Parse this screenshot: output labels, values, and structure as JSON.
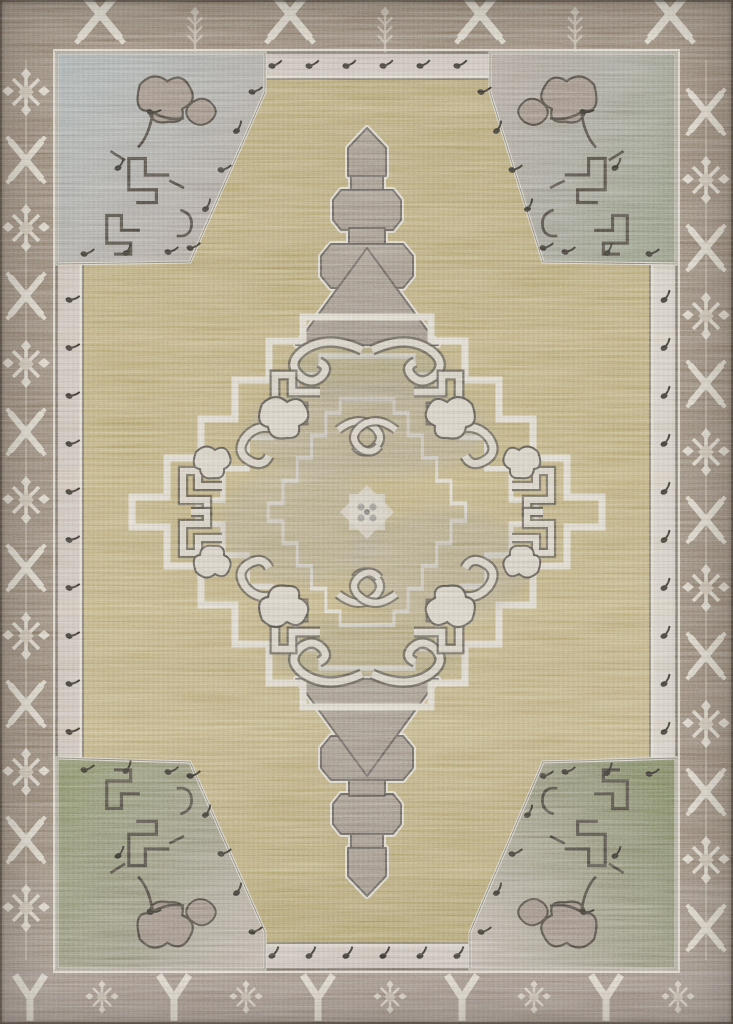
{
  "image": {
    "subject": "Flat-lay product photo of a hand-knotted style area rug: stepped gray central medallion with cream scrollwork on a gold field, four corner spandrels (blue-gray, gray-green and olive) with dark angular vine scrolls, a light dotted inner guard band, and brown tribal borders with white X, Y and snowflake motifs",
    "alt": "Tan, gray and olive geometric medallion area rug"
  },
  "palette": {
    "border_brown": "#8b7a68",
    "border_brown_deep": "#7c6c5b",
    "border_mauve": "#9c8d83",
    "motif_white": "#e7e0d1",
    "motif_dim": "#cfc5b2",
    "band_light": "#c6bab0",
    "band_light2": "#cfc8bd",
    "band_line_dark": "#57524a",
    "band_line_light": "#ded8ca",
    "dot_black": "#2b2822",
    "field_gold": "#b3a26c",
    "field_gold_light": "#c9b98a",
    "field_gold_dark": "#97874f",
    "spandrel_bluegray": "#9da7a6",
    "spandrel_mauve": "#a89a90",
    "spandrel_green": "#7a8158",
    "spandrel_mauve_light": "#b5a99e",
    "scroll_dark": "#3f3a32",
    "scroll_fill": "#8f8073",
    "medallion_gray": "#8b8780",
    "medallion_gray_light": "#989288",
    "medallion_gray_dark": "#7b7770",
    "medallion_core": "#747066",
    "pendant_mauve": "#948879",
    "cream": "#cfc8b9",
    "outline_dark": "#55504a",
    "halo_light": "#d8d2c4"
  }
}
